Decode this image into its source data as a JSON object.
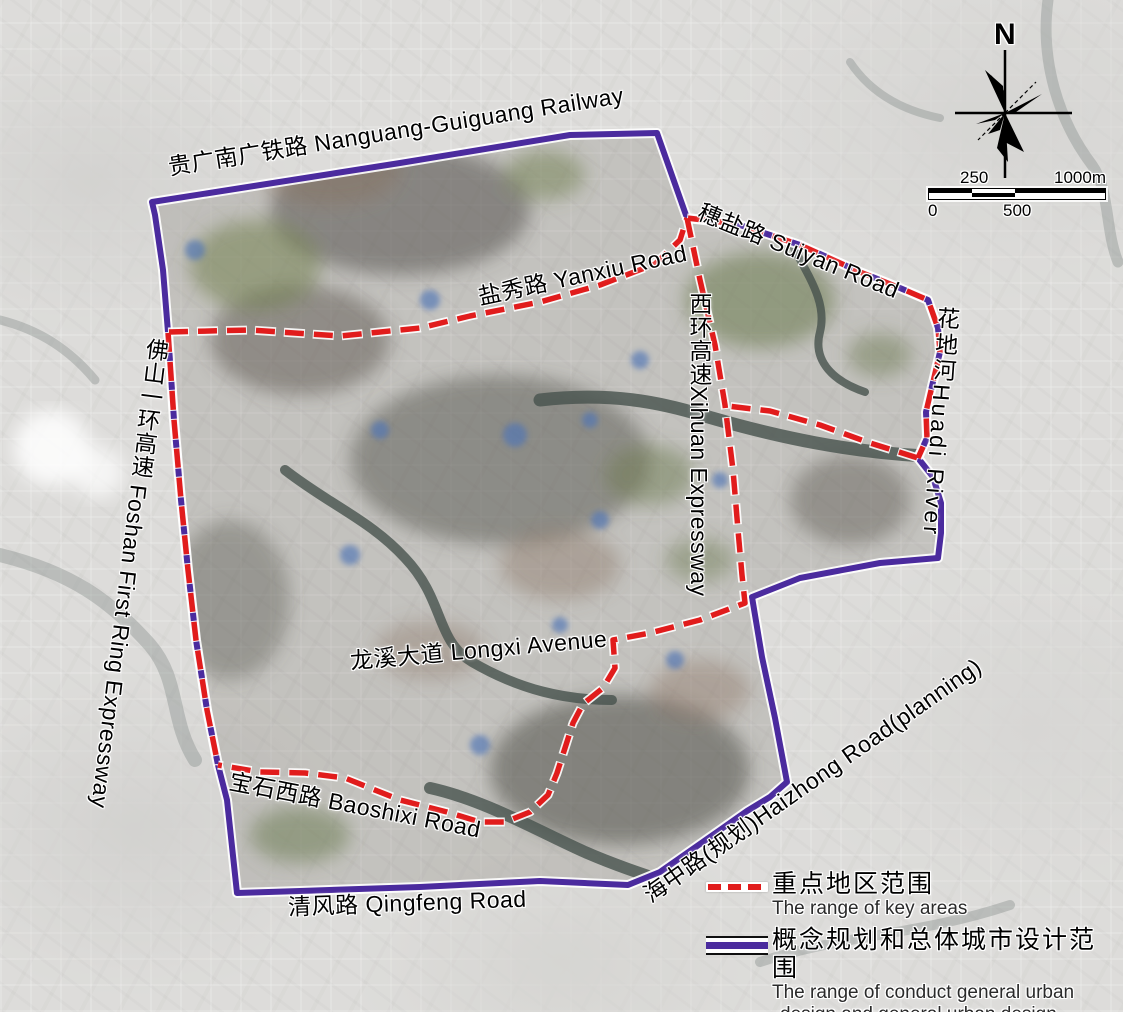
{
  "map_labels": {
    "railway": "贵广南广铁路 Nanguang-Guiguang Railway",
    "suiyan": "穗盐路 Suiyan Road",
    "yanxiu": "盐秀路 Yanxiu Road",
    "xihuan": "西环高速Xihuan Expressway",
    "huadi": "花地河Huadi River",
    "foshan_ring": "佛山一环高速 Foshan First Ring Expressway",
    "longxi": "龙溪大道 Longxi Avenue",
    "baoshixi": "宝石西路 Baoshixi Road",
    "qingfeng": "清风路 Qingfeng Road",
    "haizhong": "海中路(规划)Haizhong Road(planning)"
  },
  "compass": {
    "north": "N"
  },
  "scale_bar": {
    "tick_250": "250",
    "tick_1000": "1000m",
    "tick_0": "0",
    "tick_500": "500"
  },
  "legend": {
    "items": [
      {
        "swatch": "red-dashed-line",
        "label_zh": "重点地区范围",
        "label_en": "The range of key areas"
      },
      {
        "swatch": "purple-road-line",
        "label_zh": "概念规划和总体城市设计范围",
        "label_en_line1": "The range of conduct general urban",
        "label_en_line2": "design and general urban design"
      }
    ]
  },
  "colors": {
    "key_area_red": "#e11c1c",
    "design_range_purple": "#4b2b9e",
    "label_text": "#000000",
    "label_halo": "#ffffff"
  }
}
